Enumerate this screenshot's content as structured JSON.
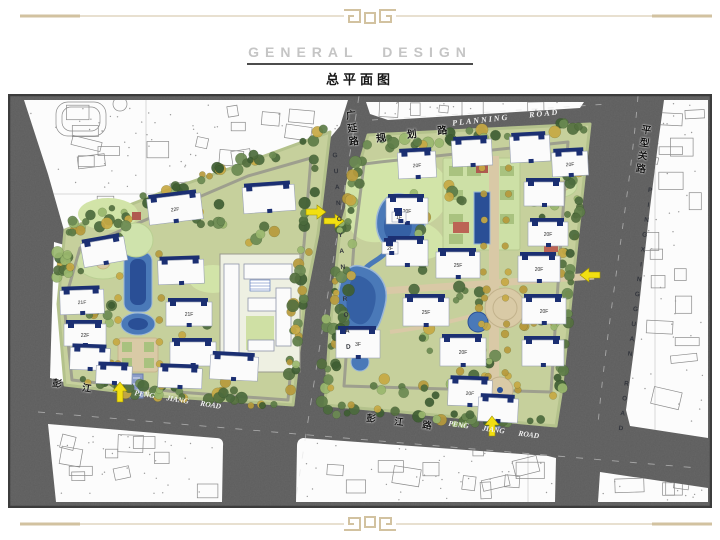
{
  "slide": {
    "title_en": "GENERAL  DESIGN",
    "title_cn": "总平面图"
  },
  "map": {
    "roads": {
      "planning_cn": "规 划 路",
      "planning_en": "PLANNING ROAD",
      "guangyan_cn": "广延路",
      "guangyan_en": "GUANGYAN ROAD",
      "pingxingguan_cn": "平型关路",
      "pingxingguan_en": "PINGXINGGUAN ROAD",
      "pengjiang_cn_west": "彭 江",
      "pengjiang_en_west": "PENG JIANG ROAD",
      "pengjiang_cn_mid": "彭 江 路",
      "pengjiang_en_mid": "PENG JIANG ROAD"
    },
    "floor_labels": {
      "f25": "25F",
      "f22": "22F",
      "f21": "21F",
      "f20": "20F",
      "f3": "3F",
      "f2": "2F",
      "f1": "1F"
    },
    "entrance_arrows": [
      {
        "id": "west-parcel-south-entrance",
        "dir": "up"
      },
      {
        "id": "east-parcel-south-entrance",
        "dir": "up"
      },
      {
        "id": "west-parcel-east-entrance",
        "dir": "right"
      },
      {
        "id": "east-parcel-west-entrance",
        "dir": "right"
      },
      {
        "id": "east-parcel-east-entrance",
        "dir": "left"
      }
    ],
    "colors": {
      "road": "#5d5d5d",
      "site_green": "#c6d09c",
      "water": "#4a79b8",
      "water_deep": "#2a4f96",
      "tree_dark": "#4c6b3d",
      "tree_gold": "#b79a3c",
      "building_navy": "#1b2f72",
      "arrow_yellow": "#f2df12",
      "border_tan": "#d2c2a0"
    }
  }
}
